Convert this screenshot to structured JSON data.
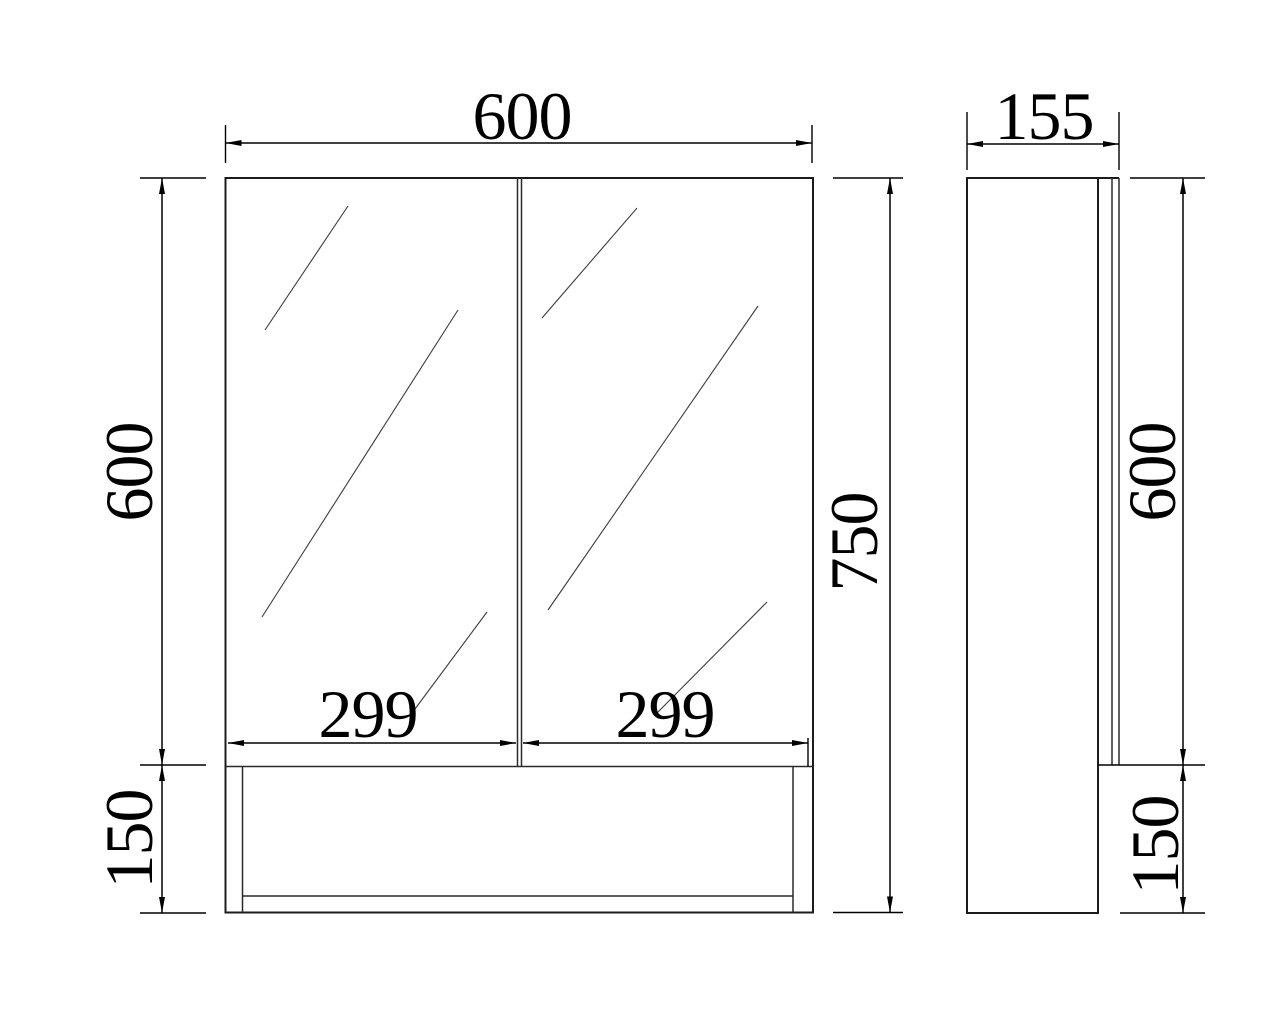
{
  "drawing": {
    "type": "cad-orthographic-dimension-drawing",
    "subject": "two-door mirror cabinet with open bottom shelf, front view and side view",
    "units_shown": "none (numeric labels only)",
    "colors": {
      "background": "#ffffff",
      "line": "#1c1c1c",
      "dimension_text": "#000000"
    },
    "dimensions": {
      "front_width": "600",
      "side_depth": "155",
      "front_mirror_height": "600",
      "front_total_height": "750",
      "left_door_width": "299",
      "right_door_width": "299",
      "front_shelf_height": "150",
      "side_mirror_height": "600",
      "side_shelf_height": "150"
    }
  }
}
